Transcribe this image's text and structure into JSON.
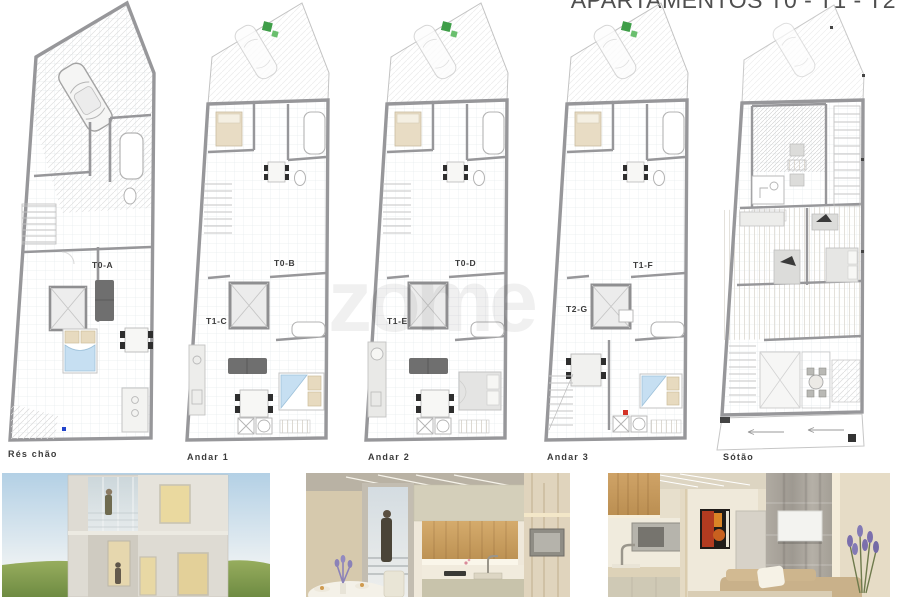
{
  "title": "APARTAMENTOS T0 - T1 - T2",
  "watermark": "zome",
  "sheet": {
    "floors": [
      {
        "name": "Rés chão",
        "units": [
          "T0-A"
        ]
      },
      {
        "name": "Andar 1",
        "units": [
          "T0-B",
          "T1-C"
        ]
      },
      {
        "name": "Andar 2",
        "units": [
          "T0-D",
          "T1-E"
        ]
      },
      {
        "name": "Andar 3",
        "units": [
          "T1-F",
          "T2-G"
        ]
      },
      {
        "name": "Sótão",
        "units": []
      }
    ]
  },
  "colors": {
    "wall_gray": "#97979a",
    "thin_line": "#c9c9c9",
    "bed_blue": "#c6dff2",
    "pillow_beige": "#e7dabf",
    "sofa_dark": "#6f6f6f",
    "green_marker": "#3f9e49",
    "blue_marker": "#2244cc",
    "red_marker": "#d33327",
    "title_text": "#4f4f4f",
    "label_text": "#3b3b3b"
  },
  "photos": [
    {
      "name": "exterior-facade-render"
    },
    {
      "name": "kitchen-interior-render"
    },
    {
      "name": "living-room-interior-render"
    }
  ]
}
